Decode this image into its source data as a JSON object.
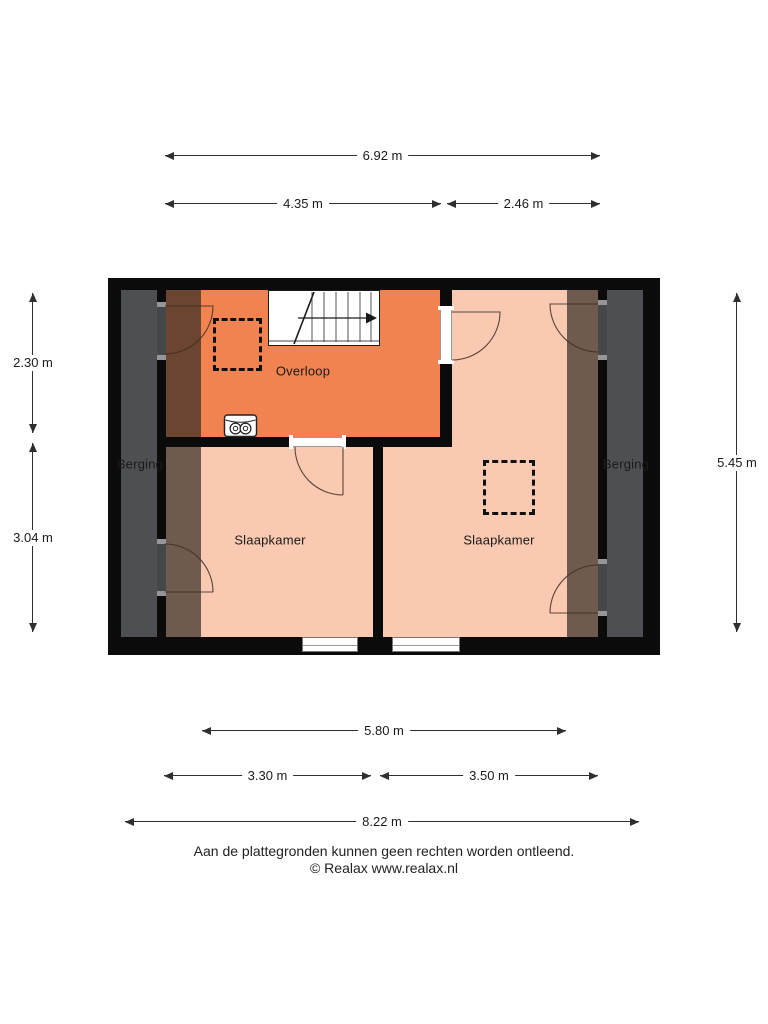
{
  "plan_title": "floorplan-first-floor",
  "rooms": {
    "overloop": "Overloop",
    "slaapkamer_left": "Slaapkamer",
    "slaapkamer_right": "Slaapkamer",
    "berging_left": "Berging",
    "berging_right": "Berging"
  },
  "dimensions": {
    "top_total": "6.92 m",
    "top_left": "4.35 m",
    "top_right": "2.46 m",
    "left_upper": "2.30 m",
    "left_lower": "3.04 m",
    "right_total": "5.45 m",
    "bottom_inner": "5.80 m",
    "bottom_left": "3.30 m",
    "bottom_right": "3.50 m",
    "bottom_total": "8.22 m"
  },
  "footer": {
    "disclaimer": "Aan de plattegronden kunnen geen rechten worden ontleend.",
    "copyright": "© Realax www.realax.nl"
  },
  "colors": {
    "room-orange": "#f08350",
    "room-pink": "#f9c9b1",
    "room-orange-shaded": "#6b4530",
    "room-pink-shaded": "#6f5a4f",
    "berging-floor": "#4e4f52",
    "wall": "#0b0b0b",
    "dim-line": "#2f2f2f",
    "text": "#1b1b1b"
  }
}
